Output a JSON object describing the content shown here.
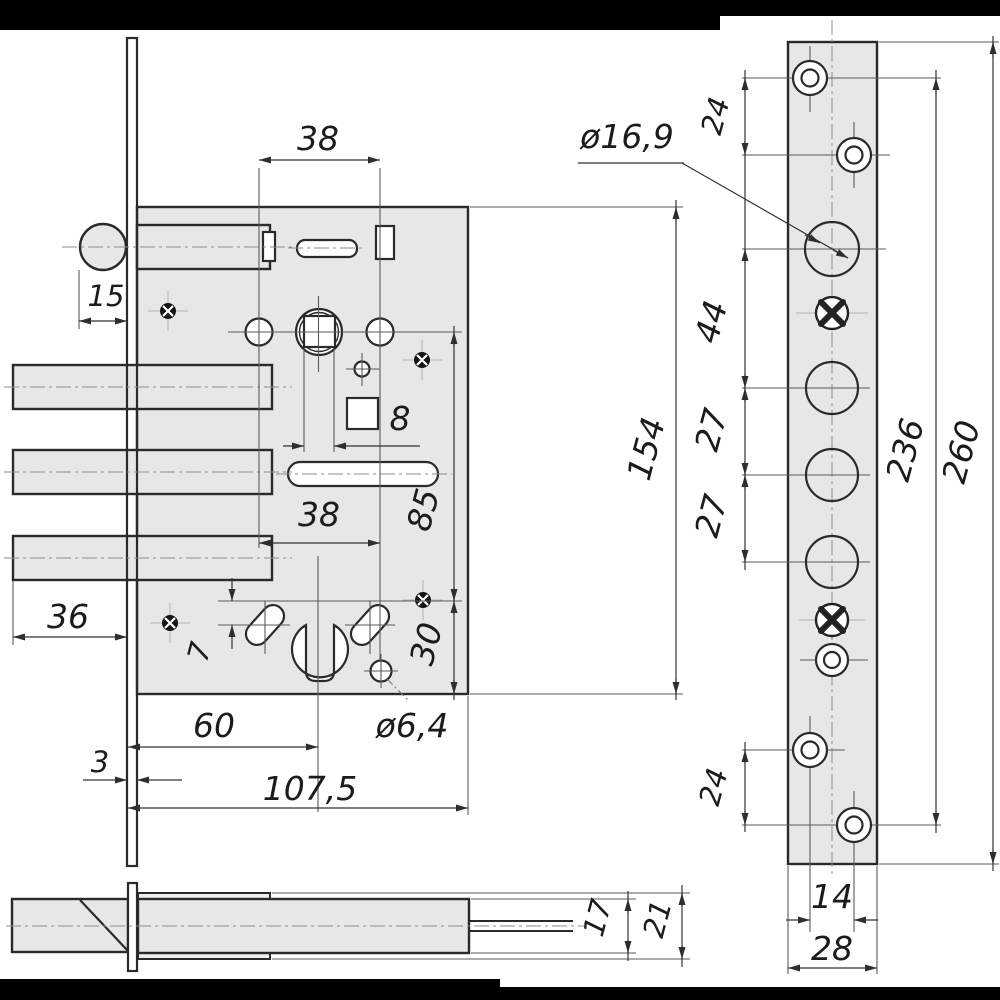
{
  "front_view": {
    "dims": {
      "handle_screw_spacing_top": "38",
      "latch_projection": "15",
      "follower_square_size": "8",
      "screw_spacing_lower": "38",
      "handle_to_cylinder_distance": "85",
      "slot_vertical_offset": "7",
      "bolt_projection": "36",
      "cylinder_to_case_bottom": "30",
      "backset": "60",
      "fixing_hole_diameter": "ø6,4",
      "faceplate_thickness": "3",
      "case_depth": "107,5",
      "case_height": "154"
    }
  },
  "faceplate_view": {
    "dims": {
      "top_screw_spacing": "24",
      "latch_hole_diameter": "ø16,9",
      "latch_to_first_bolt": "44",
      "bolt_hole_spacing_1": "27",
      "bolt_hole_spacing_2": "27",
      "screw_hole_span": "236",
      "faceplate_length": "260",
      "bottom_screw_spacing": "24",
      "screw_column_offset": "14",
      "faceplate_width": "28"
    }
  },
  "bottom_view": {
    "dims": {
      "case_thickness": "17",
      "overall_thickness": "21"
    }
  },
  "colors": {
    "metal_fill": "#e7e7e7",
    "line": "#2a2a2a",
    "dim_line": "#333333",
    "centerline": "#8d8d8d",
    "letterbox": "#000000"
  }
}
